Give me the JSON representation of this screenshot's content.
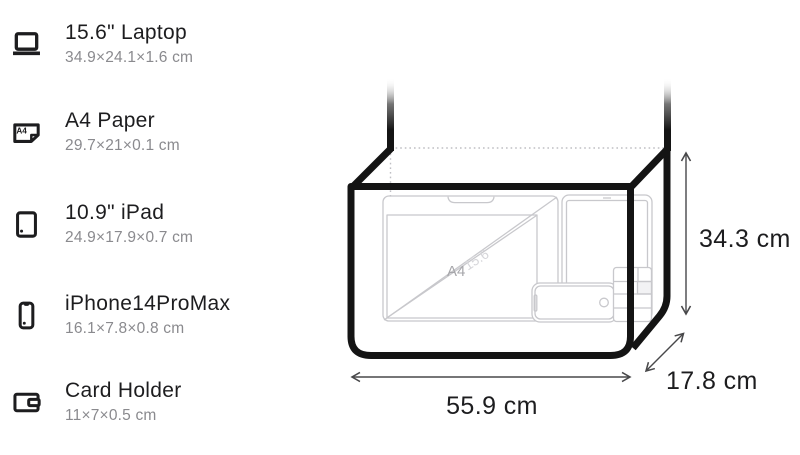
{
  "items": [
    {
      "icon": "laptop-icon",
      "name": "15.6\" Laptop",
      "dims": "34.9×24.1×1.6 cm"
    },
    {
      "icon": "a4-paper-icon",
      "name": "A4 Paper",
      "dims": "29.7×21×0.1 cm"
    },
    {
      "icon": "ipad-icon",
      "name": "10.9\" iPad",
      "dims": "24.9×17.9×0.7 cm"
    },
    {
      "icon": "iphone-icon",
      "name": "iPhone14ProMax",
      "dims": "16.1×7.8×0.8 cm"
    },
    {
      "icon": "card-holder-icon",
      "name": "Card Holder",
      "dims": "11×7×0.5 cm"
    }
  ],
  "diagram": {
    "width_label": "55.9 cm",
    "height_label": "34.3 cm",
    "depth_label": "17.8 cm",
    "interior_labels": {
      "paper": "A4",
      "laptop": "15.6"
    },
    "a4_icon_text": "A4",
    "colors": {
      "outline": "#141414",
      "label": "#1d1d1f",
      "muted": "#8a8a8e",
      "faint": "#c8c8cc",
      "faint_text": "#a6a6aa",
      "fainter_text": "#d6d6da",
      "dotted": "#bfbfc4",
      "dim_line": "#48484a",
      "shade": "#f2f2f4"
    }
  }
}
